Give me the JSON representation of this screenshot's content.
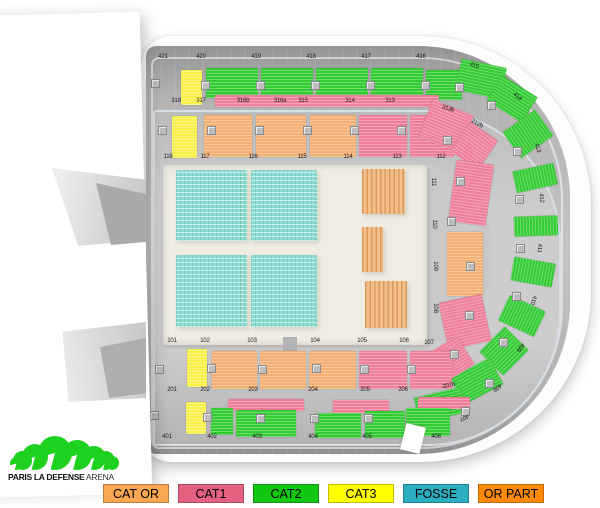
{
  "venue": {
    "name": "PARIS LA DEFENSE",
    "suffix": "ARENA"
  },
  "legend": {
    "items": [
      {
        "label": "CAT OR",
        "color": "#F9A851"
      },
      {
        "label": "CAT1",
        "color": "#E4627F"
      },
      {
        "label": "CAT2",
        "color": "#12C712"
      },
      {
        "label": "CAT3",
        "color": "#FFFF00"
      },
      {
        "label": "FOSSE",
        "color": "#2BAEC0"
      },
      {
        "label": "OR PART",
        "color": "#FF8A05"
      }
    ]
  },
  "logo": {
    "color": "#1FD11F",
    "arc_sizes": [
      13,
      19,
      26,
      34,
      30,
      24,
      19,
      14
    ]
  },
  "map": {
    "colors": {
      "y": "#F8F04A",
      "g": "#33CB33",
      "p": "#EE7E99",
      "o": "#F5AF72",
      "f": "#8EDBD2",
      "fo": "#F3BF8D"
    },
    "sections": [
      {
        "x": 181,
        "y": 70,
        "w": 21,
        "h": 35,
        "c": "y"
      },
      {
        "x": 206,
        "y": 68,
        "w": 52,
        "h": 30,
        "c": "g"
      },
      {
        "x": 261,
        "y": 68,
        "w": 52,
        "h": 30,
        "c": "g"
      },
      {
        "x": 316,
        "y": 68,
        "w": 52,
        "h": 30,
        "c": "g"
      },
      {
        "x": 371,
        "y": 68,
        "w": 52,
        "h": 30,
        "c": "g"
      },
      {
        "x": 426,
        "y": 70,
        "w": 36,
        "h": 30,
        "c": "g"
      },
      {
        "x": 215,
        "y": 95,
        "w": 224,
        "h": 12,
        "c": "p"
      },
      {
        "x": 458,
        "y": 63,
        "w": 46,
        "h": 32,
        "c": "g",
        "r": 12
      },
      {
        "x": 491,
        "y": 84,
        "w": 42,
        "h": 30,
        "c": "g",
        "r": 32
      },
      {
        "x": 512,
        "y": 114,
        "w": 32,
        "h": 40,
        "c": "g",
        "r": 55
      },
      {
        "x": 524,
        "y": 157,
        "w": 22,
        "h": 42,
        "c": "g",
        "r": 78
      },
      {
        "x": 526,
        "y": 204,
        "w": 20,
        "h": 44,
        "c": "g",
        "r": 88
      },
      {
        "x": 521,
        "y": 251,
        "w": 24,
        "h": 42,
        "c": "g",
        "r": 100
      },
      {
        "x": 508,
        "y": 296,
        "w": 28,
        "h": 40,
        "c": "g",
        "r": 115
      },
      {
        "x": 486,
        "y": 334,
        "w": 36,
        "h": 34,
        "c": "g",
        "r": 135
      },
      {
        "x": 455,
        "y": 366,
        "w": 44,
        "h": 30,
        "c": "g",
        "r": 152
      },
      {
        "x": 416,
        "y": 392,
        "w": 48,
        "h": 26,
        "c": "g",
        "r": 167
      },
      {
        "x": 172,
        "y": 116,
        "w": 25,
        "h": 42,
        "c": "y"
      },
      {
        "x": 204,
        "y": 115,
        "w": 48,
        "h": 42,
        "c": "o"
      },
      {
        "x": 256,
        "y": 115,
        "w": 50,
        "h": 42,
        "c": "o"
      },
      {
        "x": 310,
        "y": 115,
        "w": 46,
        "h": 42,
        "c": "o"
      },
      {
        "x": 359,
        "y": 115,
        "w": 48,
        "h": 42,
        "c": "p"
      },
      {
        "x": 410,
        "y": 115,
        "w": 44,
        "h": 42,
        "c": "p"
      },
      {
        "x": 424,
        "y": 106,
        "w": 44,
        "h": 40,
        "c": "p",
        "r": 22
      },
      {
        "x": 457,
        "y": 128,
        "w": 34,
        "h": 36,
        "c": "p",
        "r": 35
      },
      {
        "x": 452,
        "y": 162,
        "w": 38,
        "h": 62,
        "c": "p",
        "r": 8
      },
      {
        "x": 447,
        "y": 232,
        "w": 36,
        "h": 64,
        "c": "o"
      },
      {
        "x": 443,
        "y": 298,
        "w": 44,
        "h": 48,
        "c": "p",
        "r": -12
      },
      {
        "x": 427,
        "y": 344,
        "w": 42,
        "h": 34,
        "c": "p",
        "r": -32
      },
      {
        "x": 187,
        "y": 349,
        "w": 20,
        "h": 38,
        "c": "y"
      },
      {
        "x": 212,
        "y": 351,
        "w": 45,
        "h": 38,
        "c": "o"
      },
      {
        "x": 260,
        "y": 351,
        "w": 46,
        "h": 38,
        "c": "o"
      },
      {
        "x": 309,
        "y": 351,
        "w": 47,
        "h": 38,
        "c": "o"
      },
      {
        "x": 359,
        "y": 351,
        "w": 48,
        "h": 38,
        "c": "p"
      },
      {
        "x": 410,
        "y": 351,
        "w": 42,
        "h": 38,
        "c": "p"
      },
      {
        "x": 186,
        "y": 402,
        "w": 20,
        "h": 32,
        "c": "y"
      },
      {
        "x": 228,
        "y": 399,
        "w": 76,
        "h": 12,
        "c": "p"
      },
      {
        "x": 333,
        "y": 400,
        "w": 56,
        "h": 13,
        "c": "p"
      },
      {
        "x": 418,
        "y": 397,
        "w": 52,
        "h": 12,
        "c": "p"
      },
      {
        "x": 211,
        "y": 408,
        "w": 22,
        "h": 27,
        "c": "g"
      },
      {
        "x": 236,
        "y": 410,
        "w": 60,
        "h": 27,
        "c": "g"
      },
      {
        "x": 315,
        "y": 413,
        "w": 46,
        "h": 25,
        "c": "g"
      },
      {
        "x": 365,
        "y": 411,
        "w": 40,
        "h": 27,
        "c": "g"
      },
      {
        "x": 406,
        "y": 408,
        "w": 44,
        "h": 28,
        "c": "g"
      },
      {
        "x": 176,
        "y": 170,
        "w": 71,
        "h": 71,
        "c": "f"
      },
      {
        "x": 251,
        "y": 170,
        "w": 66,
        "h": 71,
        "c": "f"
      },
      {
        "x": 176,
        "y": 255,
        "w": 71,
        "h": 72,
        "c": "f"
      },
      {
        "x": 251,
        "y": 255,
        "w": 66,
        "h": 72,
        "c": "f"
      },
      {
        "x": 362,
        "y": 169,
        "w": 43,
        "h": 45,
        "c": "fo"
      },
      {
        "x": 362,
        "y": 227,
        "w": 21,
        "h": 45,
        "c": "fo"
      },
      {
        "x": 365,
        "y": 281,
        "w": 42,
        "h": 47,
        "c": "fo"
      }
    ],
    "labels": [
      {
        "t": "421",
        "x": 163,
        "y": 57
      },
      {
        "t": "420",
        "x": 201,
        "y": 57
      },
      {
        "t": "419",
        "x": 256,
        "y": 57
      },
      {
        "t": "418",
        "x": 311,
        "y": 57
      },
      {
        "t": "417",
        "x": 366,
        "y": 57
      },
      {
        "t": "416",
        "x": 421,
        "y": 57
      },
      {
        "t": "415",
        "x": 474,
        "y": 66,
        "r": 20
      },
      {
        "t": "414",
        "x": 517,
        "y": 97,
        "r": 40
      },
      {
        "t": "413",
        "x": 537,
        "y": 148,
        "r": 72
      },
      {
        "t": "412",
        "x": 541,
        "y": 198,
        "r": 86
      },
      {
        "t": "411",
        "x": 539,
        "y": 248,
        "r": 94
      },
      {
        "t": "410",
        "x": 533,
        "y": 300,
        "r": 108
      },
      {
        "t": "409",
        "x": 520,
        "y": 347,
        "r": 126
      },
      {
        "t": "408",
        "x": 497,
        "y": 387,
        "r": 144
      },
      {
        "t": "407",
        "x": 464,
        "y": 417,
        "r": 158
      },
      {
        "t": "406",
        "x": 436,
        "y": 437
      },
      {
        "t": "405",
        "x": 367,
        "y": 437
      },
      {
        "t": "404",
        "x": 313,
        "y": 437
      },
      {
        "t": "403",
        "x": 257,
        "y": 437
      },
      {
        "t": "402",
        "x": 212,
        "y": 437
      },
      {
        "t": "401",
        "x": 167,
        "y": 437
      },
      {
        "t": "318",
        "x": 176,
        "y": 101
      },
      {
        "t": "317",
        "x": 201,
        "y": 101
      },
      {
        "t": "316b",
        "x": 243,
        "y": 101
      },
      {
        "t": "316a",
        "x": 280,
        "y": 101
      },
      {
        "t": "315",
        "x": 303,
        "y": 101
      },
      {
        "t": "314",
        "x": 350,
        "y": 101
      },
      {
        "t": "313",
        "x": 390,
        "y": 101
      },
      {
        "t": "313b",
        "x": 448,
        "y": 109,
        "r": 18
      },
      {
        "t": "212b",
        "x": 477,
        "y": 124,
        "r": 28
      },
      {
        "t": "118",
        "x": 168,
        "y": 157
      },
      {
        "t": "117",
        "x": 205,
        "y": 157
      },
      {
        "t": "116",
        "x": 253,
        "y": 157
      },
      {
        "t": "115",
        "x": 302,
        "y": 157
      },
      {
        "t": "114",
        "x": 348,
        "y": 157
      },
      {
        "t": "113",
        "x": 397,
        "y": 157
      },
      {
        "t": "112",
        "x": 441,
        "y": 157
      },
      {
        "t": "111",
        "x": 433,
        "y": 182,
        "r": 90
      },
      {
        "t": "110",
        "x": 434,
        "y": 224,
        "r": 90
      },
      {
        "t": "109",
        "x": 435,
        "y": 266,
        "r": 90
      },
      {
        "t": "108",
        "x": 435,
        "y": 308,
        "r": 90
      },
      {
        "t": "101",
        "x": 172,
        "y": 341
      },
      {
        "t": "102",
        "x": 205,
        "y": 341
      },
      {
        "t": "103",
        "x": 252,
        "y": 341
      },
      {
        "t": "104",
        "x": 315,
        "y": 341
      },
      {
        "t": "105",
        "x": 362,
        "y": 341
      },
      {
        "t": "106",
        "x": 404,
        "y": 341
      },
      {
        "t": "107",
        "x": 429,
        "y": 343
      },
      {
        "t": "201",
        "x": 172,
        "y": 390
      },
      {
        "t": "202",
        "x": 205,
        "y": 390
      },
      {
        "t": "203",
        "x": 253,
        "y": 390
      },
      {
        "t": "204",
        "x": 313,
        "y": 390
      },
      {
        "t": "205",
        "x": 365,
        "y": 390
      },
      {
        "t": "206",
        "x": 403,
        "y": 390
      },
      {
        "t": "207b",
        "x": 449,
        "y": 386,
        "r": -12
      }
    ],
    "entrances": [
      [
        151,
        79
      ],
      [
        201,
        81
      ],
      [
        256,
        81
      ],
      [
        311,
        81
      ],
      [
        366,
        81
      ],
      [
        421,
        81
      ],
      [
        158,
        126
      ],
      [
        207,
        126
      ],
      [
        255,
        126
      ],
      [
        303,
        126
      ],
      [
        350,
        126
      ],
      [
        397,
        126
      ],
      [
        155,
        365
      ],
      [
        207,
        364
      ],
      [
        258,
        365
      ],
      [
        312,
        364
      ],
      [
        360,
        365
      ],
      [
        407,
        365
      ],
      [
        150,
        411
      ],
      [
        203,
        413
      ],
      [
        256,
        414
      ],
      [
        310,
        414
      ],
      [
        364,
        414
      ],
      [
        455,
        83
      ],
      [
        487,
        101
      ],
      [
        513,
        147
      ],
      [
        515,
        195
      ],
      [
        516,
        244
      ],
      [
        512,
        292
      ],
      [
        499,
        338
      ],
      [
        485,
        379
      ],
      [
        461,
        407
      ],
      [
        443,
        136
      ],
      [
        456,
        177
      ],
      [
        447,
        217
      ],
      [
        466,
        262
      ],
      [
        465,
        311
      ],
      [
        450,
        350
      ]
    ]
  }
}
